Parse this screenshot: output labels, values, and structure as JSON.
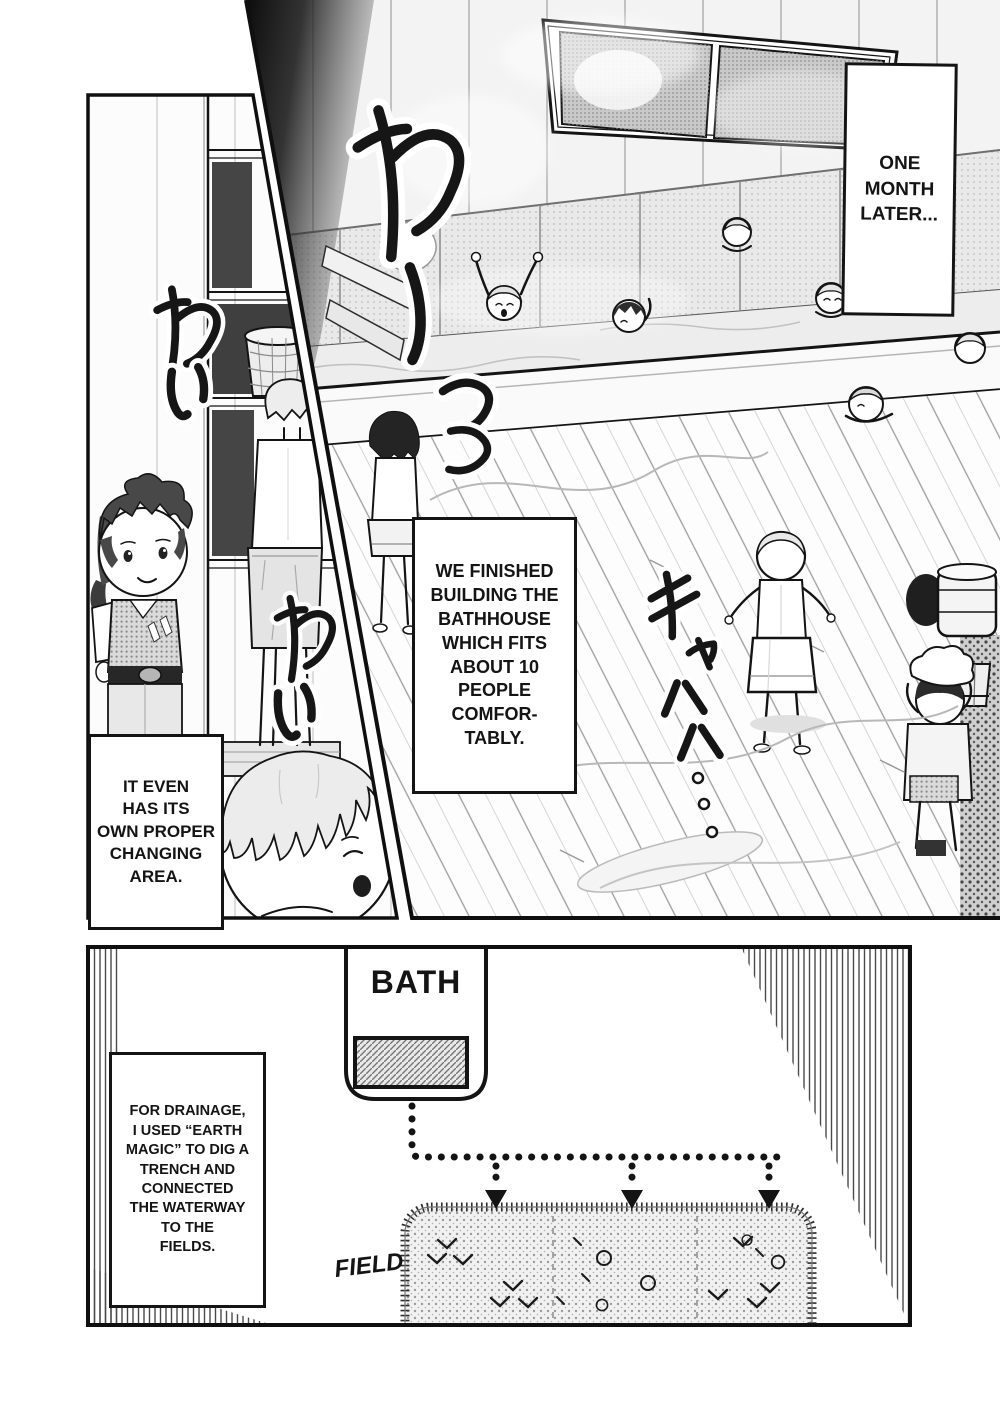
{
  "page": {
    "kind": "manga page",
    "background": "#ffffff",
    "ink": "#141414"
  },
  "panels": {
    "bath_scene": {
      "description": "bathhouse interior with wooden tub, window, steam and children bathing",
      "captions": {
        "time": "ONE\nMONTH\nLATER...",
        "narration": "WE FINISHED\nBUILDING THE\nBATHHOUSE\nWHICH FITS\nABOUT 10\nPEOPLE\nCOMFOR-\nTABLY."
      },
      "sfx": [
        {
          "id": "wa-dash",
          "text": "わーっっ"
        },
        {
          "id": "kya-haha",
          "text": "キャハハ"
        }
      ]
    },
    "changing_area": {
      "description": "changing room with shelves, basket and boys",
      "caption": "IT EVEN\nHAS ITS\nOWN PROPER\nCHANGING\nAREA.",
      "sfx": [
        {
          "id": "wai-1",
          "text": "わい"
        },
        {
          "id": "wai-2",
          "text": "わい"
        }
      ]
    },
    "drainage_diagram": {
      "caption": "FOR DRAINAGE,\nI USED “EARTH\nMAGIC” TO DIG A\nTRENCH AND\nCONNECTED\nTHE WATERWAY\nTO THE\nFIELDS.",
      "labels": {
        "bath": "BATH",
        "field": "FIELD"
      }
    }
  }
}
